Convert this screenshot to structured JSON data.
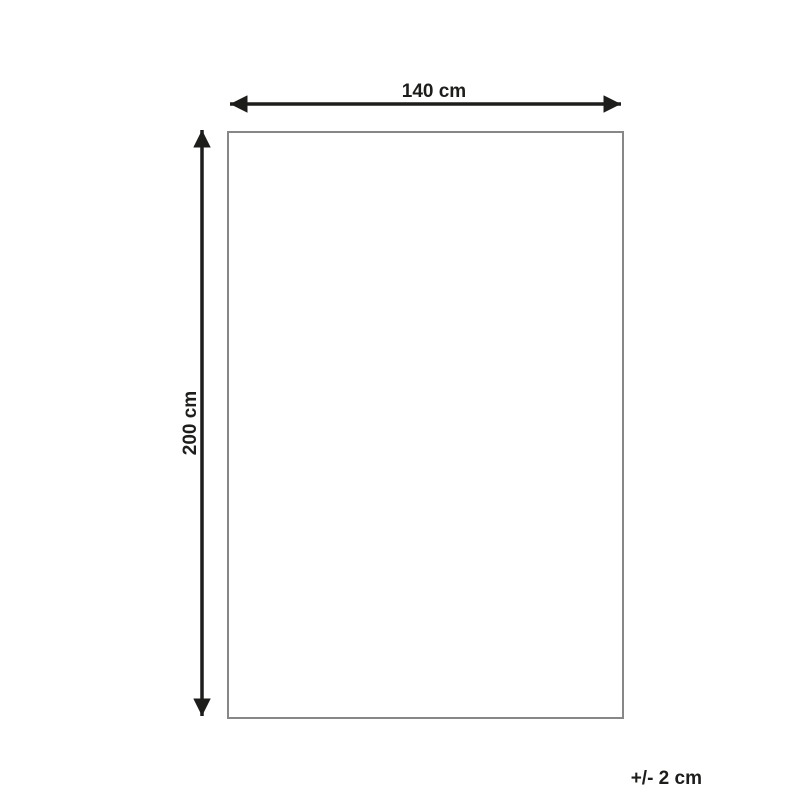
{
  "diagram": {
    "width_label": "140 cm",
    "height_label": "200 cm",
    "tolerance_label": "+/- 2 cm",
    "colors": {
      "background": "#ffffff",
      "arrow": "#1d1d1b",
      "outline": "#878787",
      "text": "#1d1d1b"
    }
  }
}
